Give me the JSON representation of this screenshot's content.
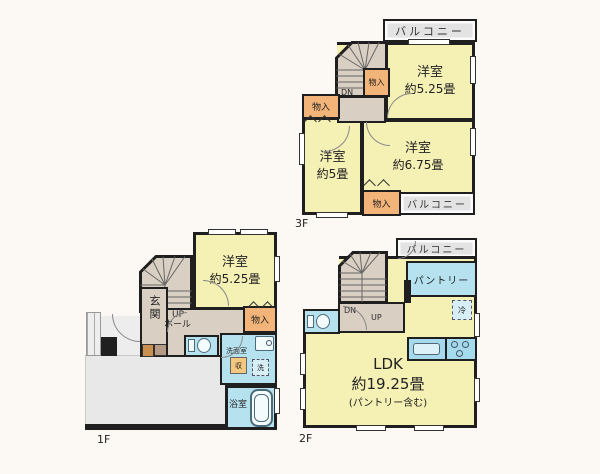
{
  "colors": {
    "page_bg": "#fcf9f5",
    "wall": "#1f1f1f",
    "room_yellow": "#f5f0b4",
    "service_beige": "#d9cfc2",
    "storage_orange": "#f2b478",
    "wet_blue": "#b6e2f0",
    "counter_blue": "#a5daec",
    "balcony_gray": "#e3e3e3",
    "terrace_gray": "#e8e8e8"
  },
  "floors": {
    "f3": {
      "floor_label": "3F",
      "balcony_top": "バルコニー",
      "balcony_bottom": "バルコニー",
      "closet_stairs": "物入",
      "closet_left": "物入",
      "closet_bottom": "物入",
      "stairs_dn": "DN",
      "room_a_name": "洋室",
      "room_a_size": "約5.25畳",
      "room_b_name": "洋室",
      "room_b_size": "約6.75畳",
      "room_c_name": "洋室",
      "room_c_size": "約5畳"
    },
    "f1": {
      "floor_label": "1F",
      "room_name": "洋室",
      "room_size": "約5.25畳",
      "entrance": "玄関",
      "hall_line1": "UP",
      "hall_line2": "ホール",
      "closet": "物入",
      "washroom": "洗面室",
      "storage_box": "収",
      "washer_box": "洗",
      "bathroom": "浴室"
    },
    "f2": {
      "floor_label": "2F",
      "balcony": "バルコニー",
      "pantry": "パントリー",
      "fridge_box": "冷",
      "stairs_dn": "DN",
      "stairs_up": "UP",
      "ldk_name": "LDK",
      "ldk_size": "約19.25畳",
      "ldk_note": "(パントリー含む)"
    }
  }
}
